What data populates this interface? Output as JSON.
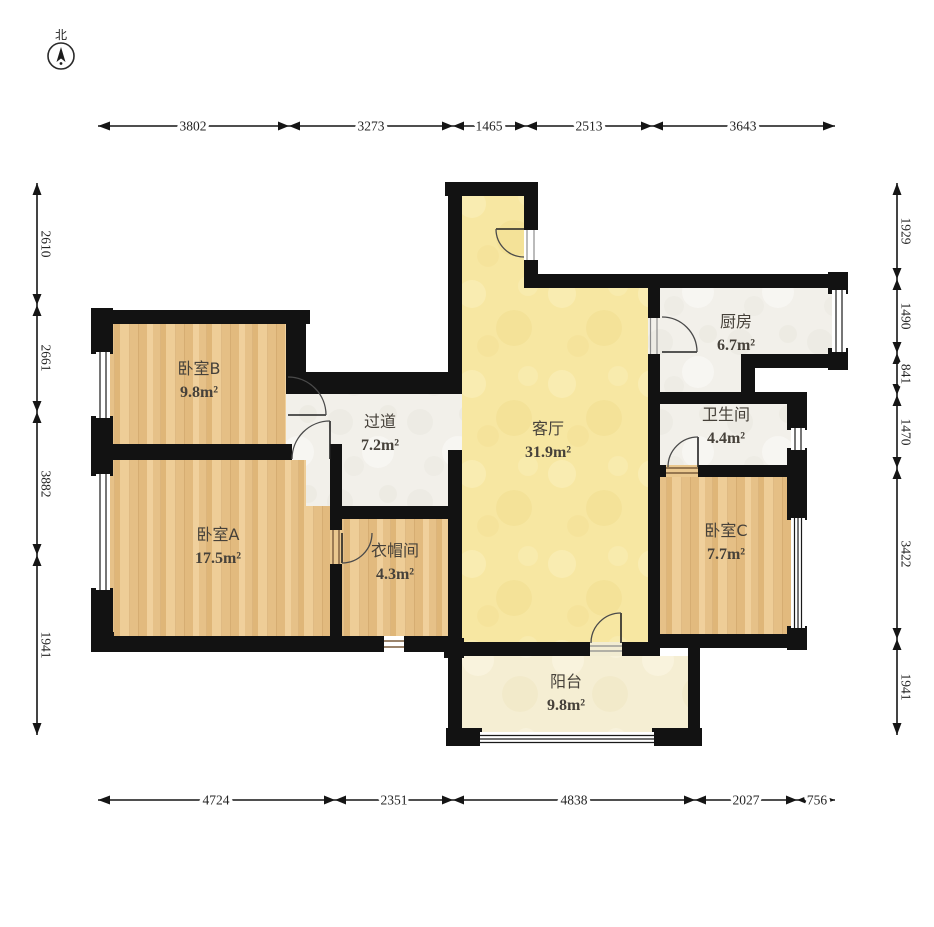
{
  "compass": {
    "label": "北"
  },
  "rooms": [
    {
      "id": "bedroom-b",
      "name": "卧室B",
      "area": "9.8m²",
      "cx": 199,
      "cy": 374
    },
    {
      "id": "bedroom-a",
      "name": "卧室A",
      "area": "17.5m²",
      "cx": 218,
      "cy": 540
    },
    {
      "id": "hallway",
      "name": "过道",
      "area": "7.2m²",
      "cx": 380,
      "cy": 427
    },
    {
      "id": "cloakroom",
      "name": "衣帽间",
      "area": "4.3m²",
      "cx": 395,
      "cy": 556
    },
    {
      "id": "living-room",
      "name": "客厅",
      "area": "31.9m²",
      "cx": 548,
      "cy": 434
    },
    {
      "id": "kitchen",
      "name": "厨房",
      "area": "6.7m²",
      "cx": 736,
      "cy": 327
    },
    {
      "id": "bathroom",
      "name": "卫生间",
      "area": "4.4m²",
      "cx": 726,
      "cy": 420
    },
    {
      "id": "bedroom-c",
      "name": "卧室C",
      "area": "7.7m²",
      "cx": 726,
      "cy": 536
    },
    {
      "id": "balcony",
      "name": "阳台",
      "area": "9.8m²",
      "cx": 566,
      "cy": 687
    }
  ],
  "dims": {
    "top": {
      "orient": "h",
      "pos": 126,
      "from": 98,
      "to": 835,
      "ticks": [
        289,
        453,
        526,
        652
      ],
      "labels": [
        {
          "t": "3802",
          "p": 193
        },
        {
          "t": "3273",
          "p": 371
        },
        {
          "t": "1465",
          "p": 489
        },
        {
          "t": "2513",
          "p": 589
        },
        {
          "t": "3643",
          "p": 743
        }
      ]
    },
    "bottom": {
      "orient": "h",
      "pos": 800,
      "from": 98,
      "to": 835,
      "ticks": [
        335,
        453,
        695,
        797
      ],
      "labels": [
        {
          "t": "4724",
          "p": 216
        },
        {
          "t": "2351",
          "p": 394
        },
        {
          "t": "4838",
          "p": 574
        },
        {
          "t": "2027",
          "p": 746
        },
        {
          "t": "756",
          "p": 817
        }
      ]
    },
    "left": {
      "orient": "v",
      "pos": 37,
      "from": 183,
      "to": 735,
      "ticks": [
        305,
        412,
        555
      ],
      "labels": [
        {
          "t": "2610",
          "p": 244
        },
        {
          "t": "2661",
          "p": 358
        },
        {
          "t": "3882",
          "p": 484
        },
        {
          "t": "1941",
          "p": 645
        }
      ]
    },
    "right": {
      "orient": "v",
      "pos": 897,
      "from": 183,
      "to": 735,
      "ticks": [
        279,
        353,
        395,
        468,
        639
      ],
      "labels": [
        {
          "t": "1929",
          "p": 231
        },
        {
          "t": "1490",
          "p": 316
        },
        {
          "t": "841",
          "p": 374
        },
        {
          "t": "1470",
          "p": 432
        },
        {
          "t": "3422",
          "p": 554
        },
        {
          "t": "1941",
          "p": 687
        }
      ]
    }
  },
  "colors": {
    "wall": "#121212",
    "wood_floor": "#eac88f",
    "living_floor": "#f7e7a2",
    "balcony_floor": "#f5eed3",
    "tile_floor": "#f2f0ea",
    "dimension_text": "#242424"
  }
}
